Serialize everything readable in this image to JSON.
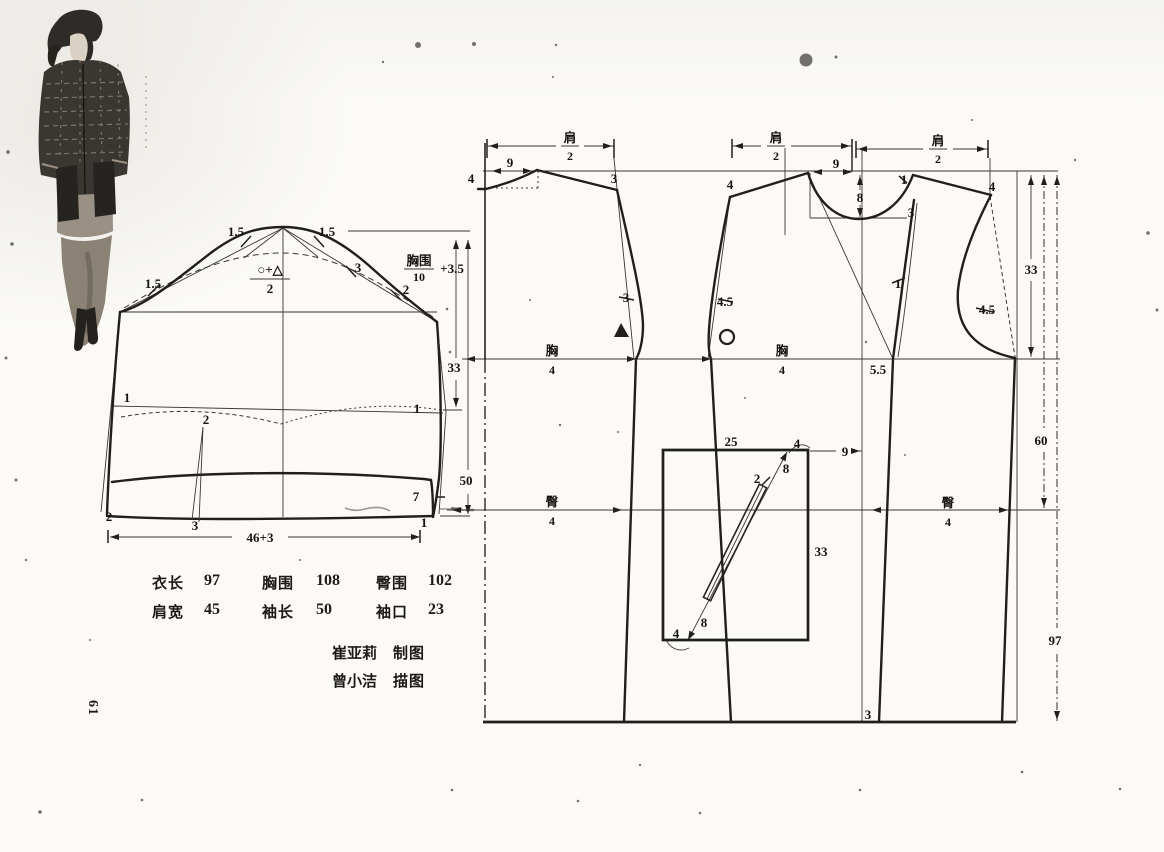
{
  "page": {
    "number": "61"
  },
  "colors": {
    "paper": "#fbfaf6",
    "ink": "#211f1c"
  },
  "size_table": {
    "rows": [
      [
        {
          "label": "衣长",
          "value": "97"
        },
        {
          "label": "胸围",
          "value": "108"
        },
        {
          "label": "臀围",
          "value": "102"
        }
      ],
      [
        {
          "label": "肩宽",
          "value": "45"
        },
        {
          "label": "袖长",
          "value": "50"
        },
        {
          "label": "袖口",
          "value": "23"
        }
      ]
    ]
  },
  "credits": [
    {
      "name": "崔亚莉",
      "role": "制图"
    },
    {
      "name": "曾小洁",
      "role": "描图"
    }
  ],
  "sleeve": {
    "labels": {
      "ease_upper_left": "1.5",
      "ease_upper_right": "1.5",
      "ease_left": "1.5",
      "ease_right": "3",
      "ease_lower_right": "2",
      "cap_formula_numerator": "○+△",
      "cap_formula_denominator": "2",
      "width_formula_numerator": "胸围",
      "width_formula_denominator": "10",
      "width_formula_plus": "+3.5",
      "elbow_height": "33",
      "sleeve_length": "50",
      "elbow_left": "1",
      "elbow_dart_top": "2",
      "elbow_right": "1",
      "cuff_left": "2",
      "elbow_dart_bottom": "3",
      "cuff_right_offset": "7",
      "cuff_right": "1",
      "cuff_width": "46+3"
    }
  },
  "bodice": {
    "shoulder_fraction": {
      "num": "肩",
      "den": "2"
    },
    "chest_fraction": {
      "num": "胸",
      "den": "4"
    },
    "hip_fraction": {
      "num": "臀",
      "den": "4"
    },
    "labels": {
      "back_neck_width": "9",
      "back_neck_depth": "4",
      "back_shoulder_point": "3",
      "back_armhole_ease": "3",
      "front_shoulder_point": "4",
      "front_armhole_ease": "4.5",
      "front_neck_width": "9",
      "front_neck_depth": "8",
      "side_neck_point": "1",
      "side_neck_curve": "3",
      "side_shoulder_point": "4",
      "side_armhole_ease": "4.5",
      "front_edge_offset": "1",
      "chest_dart_offset": "5.5",
      "hem_offset": "3",
      "armhole_depth": "33",
      "hip_length": "60",
      "garment_length": "97"
    },
    "pocket": {
      "width": "25",
      "height": "33",
      "top_end": "4",
      "upper_length": "8",
      "welt_width": "2",
      "lower_length": "8",
      "bottom_end": "4",
      "offset_from_front": "9"
    }
  }
}
